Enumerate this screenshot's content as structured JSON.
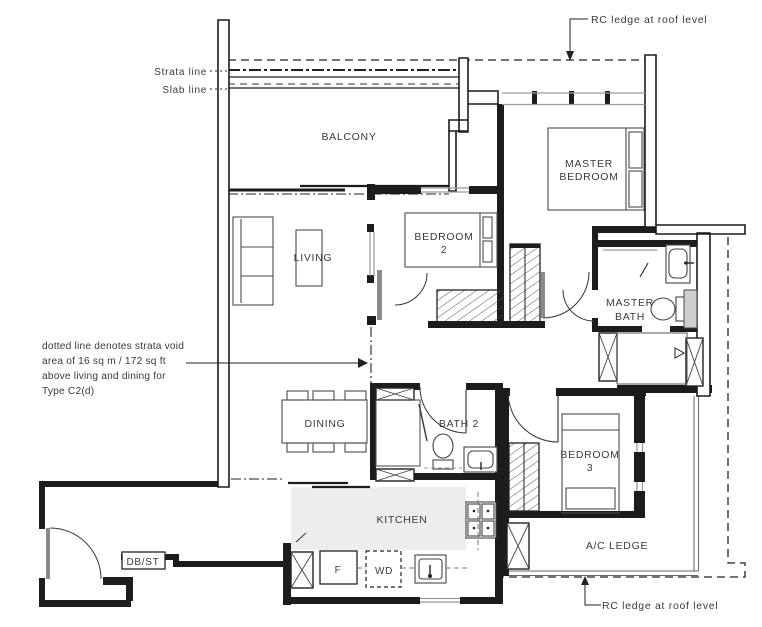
{
  "annotations": {
    "rc_ledge_top": "RC ledge at roof level",
    "rc_ledge_bottom": "RC ledge at roof level",
    "strata_line": "Strata line",
    "slab_line": "Slab line",
    "note_line1": "dotted line denotes strata void",
    "note_line2": "area of 16 sq m / 172 sq ft",
    "note_line3": "above living and dining for",
    "note_line4": "Type C2(d)"
  },
  "rooms": {
    "balcony": "BALCONY",
    "living": "LIVING",
    "dining": "DINING",
    "kitchen": "KITCHEN",
    "bath2": "BATH 2",
    "ac_ledge": "A/C LEDGE",
    "db_st": "DB/ST",
    "bedroom2": [
      "BEDROOM",
      "2"
    ],
    "bedroom3": [
      "BEDROOM",
      "3"
    ],
    "master_bedroom": [
      "MASTER",
      "BEDROOM"
    ],
    "master_bath": [
      "MASTER",
      "BATH"
    ]
  },
  "appliances": {
    "fridge": "F",
    "washer_dryer": "WD"
  },
  "colors": {
    "line": "#1c1c1c",
    "label": "#3a3a3a",
    "window": "#9a9a9a",
    "kitchen_floor": "#ededed"
  }
}
